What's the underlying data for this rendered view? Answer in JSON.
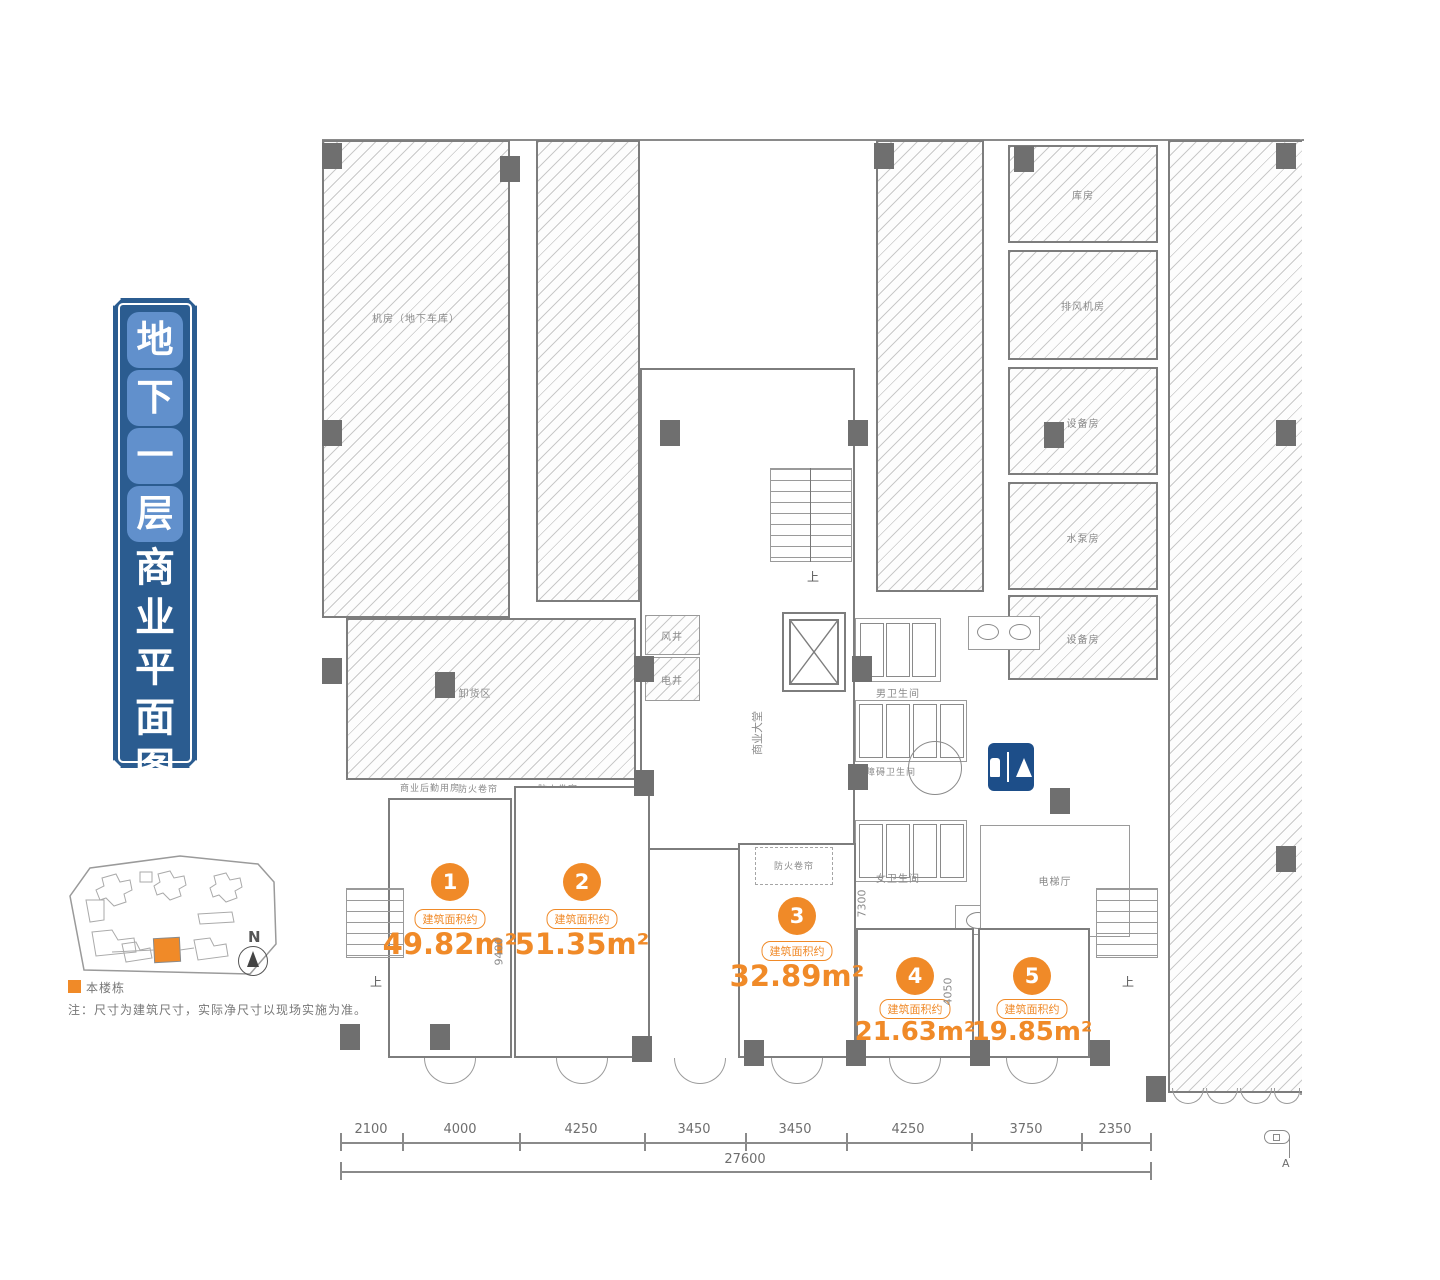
{
  "banner": {
    "highlight_chars": [
      "地",
      "下",
      "一",
      "层"
    ],
    "plain_chars": [
      "商",
      "业",
      "平",
      "面",
      "图"
    ],
    "bg_color": "#2b5c90",
    "char_bg_color": "#6190cc"
  },
  "keymap": {
    "legend_label": "本楼栋",
    "highlight_color": "#f08a28",
    "note": "注：尺寸为建筑尺寸，实际净尺寸以现场实施为准。",
    "north_label": "N"
  },
  "plan": {
    "accent_color": "#f08a28",
    "units": [
      {
        "num": "1",
        "pill": "建筑面积约",
        "area": "49.82m²"
      },
      {
        "num": "2",
        "pill": "建筑面积约",
        "area": "51.35m²"
      },
      {
        "num": "3",
        "pill": "建筑面积约",
        "area": "32.89m²"
      },
      {
        "num": "4",
        "pill": "建筑面积约",
        "area": "21.63m²"
      },
      {
        "num": "5",
        "pill": "建筑面积约",
        "area": "19.85m²"
      }
    ],
    "rooms": {
      "machine_room": "机房（地下车库）",
      "storage": "库房",
      "fan_room": "排风机房",
      "equipment1": "设备房",
      "pump_room": "水泵房",
      "equipment2": "设备房",
      "lobby": "商业大堂",
      "unloading": "卸货区",
      "logistics": "商业后勤用房",
      "shutter": "防火卷帘",
      "mens_wc": "男卫生间",
      "accessible_wc": "无障碍卫生间",
      "womens_wc": "女卫生间",
      "elevator_hall": "电梯厅",
      "shaft1": "风井",
      "shaft2": "电井"
    },
    "stair_up": "上",
    "dims": {
      "bottom": [
        "2100",
        "4000",
        "4250",
        "3450",
        "3450",
        "4250",
        "3750",
        "2350"
      ],
      "total": "27600",
      "v1": "9400",
      "v2": "7300",
      "v3": "4050"
    },
    "wc_sign_color": "#1d4e89",
    "section_marker": "A"
  }
}
